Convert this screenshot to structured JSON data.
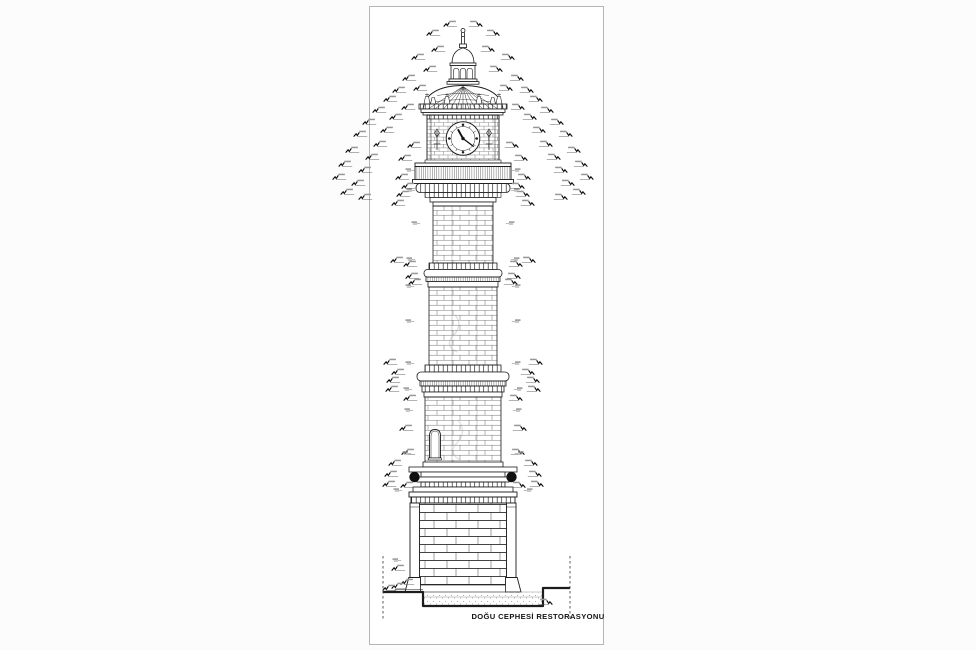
{
  "document": {
    "title": "DOĞU CEPHESİ RESTORASYONU"
  },
  "clock": {
    "hour_hand_angle_deg": -29,
    "minute_hand_angle_deg": 127
  },
  "colors": {
    "line": "#1c1c1c",
    "masonry_line": "#4a4a4a",
    "page_border": "#b5b5b5",
    "sphere_fill": "#111111",
    "annotation_ink": "#0c0c0c",
    "annotation_text": "#979797",
    "foundation_dots": "#8f8f8f",
    "background": "#ffffff"
  },
  "annotations": {
    "left_ticks": [
      [
        444,
        24
      ],
      [
        427,
        33
      ],
      [
        432,
        49
      ],
      [
        412,
        57
      ],
      [
        424,
        69
      ],
      [
        403,
        78
      ],
      [
        414,
        88
      ],
      [
        393,
        90
      ],
      [
        384,
        99
      ],
      [
        402,
        107
      ],
      [
        373,
        110
      ],
      [
        390,
        117
      ],
      [
        363,
        122
      ],
      [
        381,
        130
      ],
      [
        354,
        134
      ],
      [
        374,
        144
      ],
      [
        408,
        145
      ],
      [
        346,
        150
      ],
      [
        366,
        157
      ],
      [
        399,
        158
      ],
      [
        339,
        164
      ],
      [
        359,
        170
      ],
      [
        333,
        177
      ],
      [
        352,
        183
      ],
      [
        341,
        192
      ],
      [
        359,
        197
      ],
      [
        396,
        177
      ],
      [
        402,
        186
      ],
      [
        397,
        194
      ],
      [
        392,
        203
      ],
      [
        391,
        260
      ],
      [
        404,
        264
      ],
      [
        406,
        276
      ],
      [
        409,
        282
      ],
      [
        384,
        362
      ],
      [
        392,
        372
      ],
      [
        387,
        380
      ],
      [
        386,
        389
      ],
      [
        404,
        398
      ],
      [
        400,
        428
      ],
      [
        402,
        452
      ],
      [
        389,
        463
      ],
      [
        385,
        474
      ],
      [
        383,
        484
      ],
      [
        401,
        485
      ],
      [
        392,
        568
      ],
      [
        401,
        582
      ],
      [
        392,
        586
      ],
      [
        383,
        588
      ]
    ],
    "right_ticks": [
      [
        482,
        24
      ],
      [
        499,
        33
      ],
      [
        494,
        49
      ],
      [
        514,
        57
      ],
      [
        502,
        69
      ],
      [
        523,
        78
      ],
      [
        512,
        88
      ],
      [
        533,
        90
      ],
      [
        542,
        99
      ],
      [
        524,
        107
      ],
      [
        553,
        110
      ],
      [
        536,
        117
      ],
      [
        563,
        122
      ],
      [
        545,
        130
      ],
      [
        572,
        134
      ],
      [
        552,
        144
      ],
      [
        518,
        145
      ],
      [
        580,
        150
      ],
      [
        560,
        157
      ],
      [
        527,
        158
      ],
      [
        587,
        164
      ],
      [
        567,
        170
      ],
      [
        593,
        177
      ],
      [
        574,
        183
      ],
      [
        585,
        192
      ],
      [
        567,
        197
      ],
      [
        530,
        177
      ],
      [
        524,
        186
      ],
      [
        529,
        194
      ],
      [
        534,
        203
      ],
      [
        535,
        260
      ],
      [
        522,
        264
      ],
      [
        520,
        276
      ],
      [
        517,
        282
      ],
      [
        542,
        362
      ],
      [
        534,
        372
      ],
      [
        539,
        380
      ],
      [
        540,
        389
      ],
      [
        522,
        398
      ],
      [
        526,
        428
      ],
      [
        524,
        452
      ],
      [
        537,
        463
      ],
      [
        541,
        474
      ],
      [
        543,
        484
      ],
      [
        525,
        485
      ],
      [
        552,
        602
      ]
    ],
    "left_labels": [
      [
        411,
        170
      ],
      [
        412,
        190
      ],
      [
        417,
        223
      ],
      [
        412,
        259
      ],
      [
        411,
        286
      ],
      [
        411,
        321
      ],
      [
        411,
        363
      ],
      [
        409,
        389
      ],
      [
        410,
        410
      ],
      [
        408,
        453
      ],
      [
        399,
        490
      ],
      [
        398,
        560
      ]
    ],
    "right_labels": [
      [
        515,
        170
      ],
      [
        514,
        190
      ],
      [
        509,
        223
      ],
      [
        514,
        259
      ],
      [
        515,
        286
      ],
      [
        515,
        321
      ],
      [
        515,
        363
      ],
      [
        517,
        389
      ],
      [
        516,
        410
      ],
      [
        518,
        453
      ],
      [
        527,
        490
      ]
    ]
  }
}
